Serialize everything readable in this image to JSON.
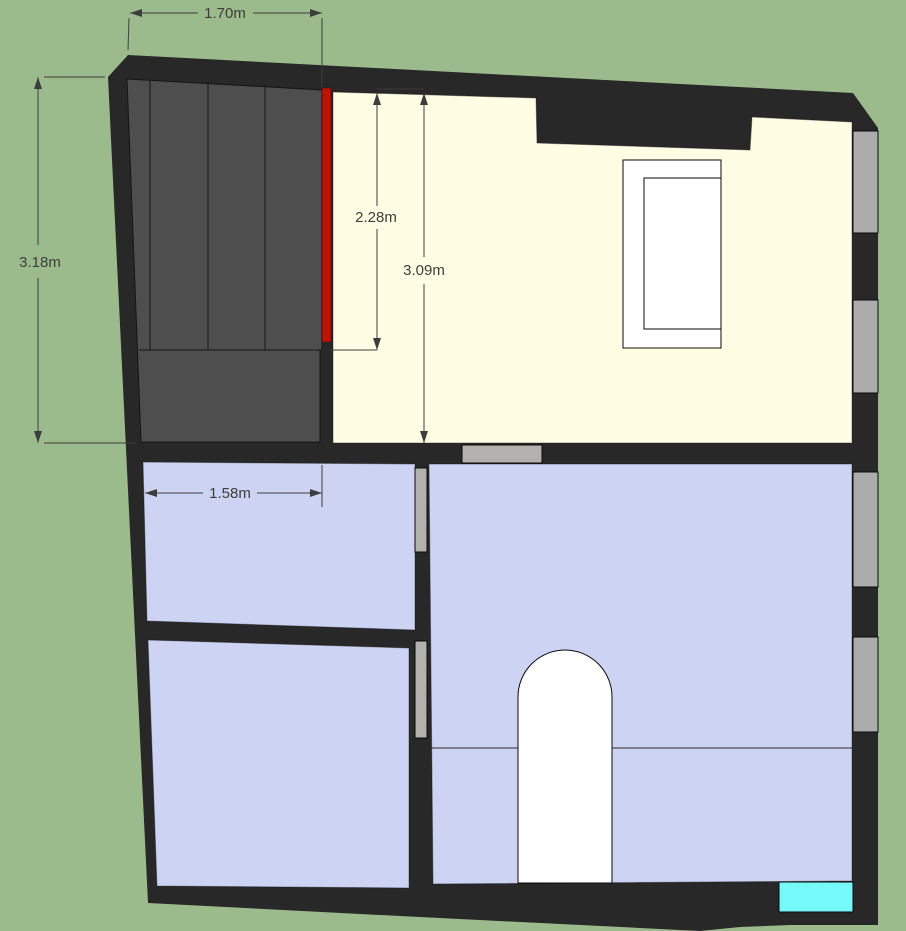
{
  "title": "Floor plan model view",
  "colors": {
    "background": "#9cbb8c",
    "wall": "#282828",
    "stairs": "#4e4e4e",
    "stair-edge": "#151515",
    "red-edge": "#c31100",
    "upper-floor": "#fffde4",
    "lower-floor": "#cdd3f2",
    "window": "#acacac",
    "door-opening": "#b2b1ad",
    "counter": "#76f9f9",
    "object-white": "#ffffff",
    "dimension": "#3d3d3d"
  },
  "dimensions": [
    {
      "label": "1.70m"
    },
    {
      "label": "3.18m"
    },
    {
      "label": "2.28m"
    },
    {
      "label": "3.09m"
    },
    {
      "label": "1.58m"
    }
  ]
}
